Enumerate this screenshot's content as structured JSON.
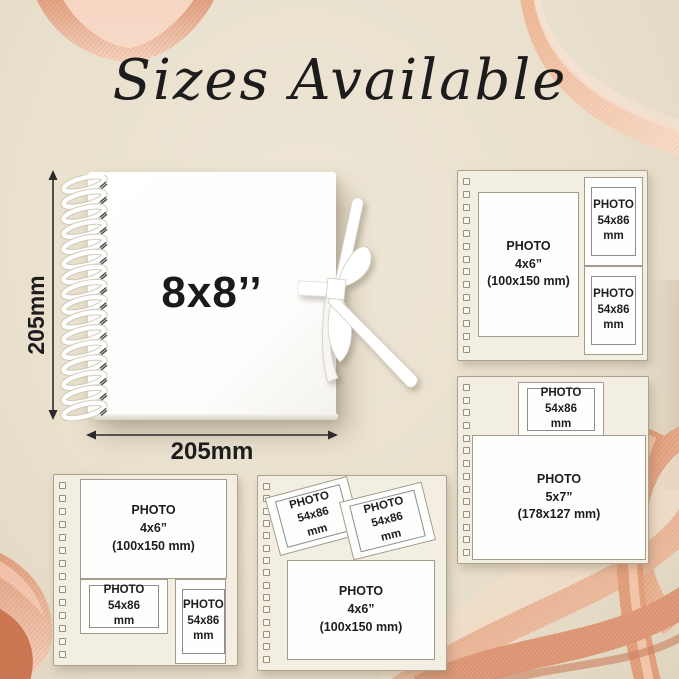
{
  "title": "Sizes Available",
  "book": {
    "size_label": "8x8’’",
    "height_label": "205mm",
    "width_label": "205mm"
  },
  "panels": {
    "top_right": {
      "slots": [
        {
          "label": "PHOTO\n4x6”\n(100x150 mm)"
        },
        {
          "label": "PHOTO\n54x86\nmm"
        },
        {
          "label": "PHOTO\n54x86\nmm"
        }
      ]
    },
    "middle_right": {
      "slots": [
        {
          "label": "PHOTO\n54x86\nmm"
        },
        {
          "label": "PHOTO\n5x7”\n(178x127 mm)"
        }
      ]
    },
    "bottom_left": {
      "slots": [
        {
          "label": "PHOTO\n4x6”\n(100x150 mm)"
        },
        {
          "label": "PHOTO\n54x86\nmm"
        },
        {
          "label": "PHOTO\n54x86\nmm"
        }
      ]
    },
    "bottom_middle": {
      "slots": [
        {
          "label": "PHOTO\n54x86\nmm"
        },
        {
          "label": "PHOTO\n54x86\nmm"
        },
        {
          "label": "PHOTO\n4x6”\n(100x150 mm)"
        }
      ]
    }
  },
  "colors": {
    "background": "#e9e0cd",
    "page_panel": "#f3eee2",
    "photo_box": "#fefefd",
    "ribbon_peach": "#e7a583",
    "ribbon_light": "#f7d6c2",
    "ribbon_deep": "#cd7753",
    "ink": "#1c1c1c"
  }
}
